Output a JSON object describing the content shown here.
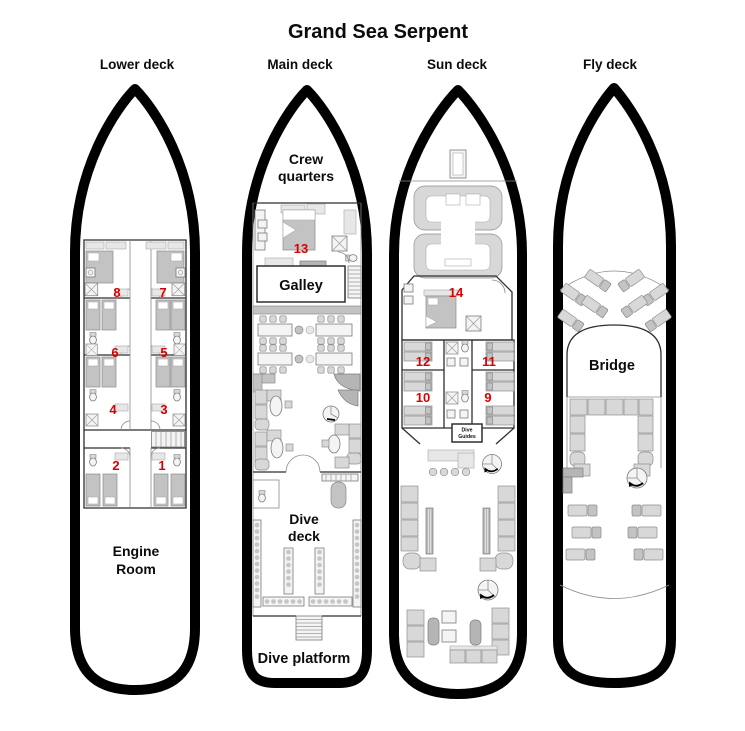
{
  "title": "Grand Sea Serpent",
  "colors": {
    "cabin_number_red": "#d90000",
    "hull_outline": "#000000",
    "furniture_gray": "#d8d8d8",
    "background": "#ffffff"
  },
  "decks": {
    "lower": {
      "label": "Lower deck",
      "cabin_numbers": [
        "1",
        "2",
        "3",
        "4",
        "5",
        "6",
        "7",
        "8"
      ],
      "rooms": {
        "engine_line1": "Engine",
        "engine_line2": "Room"
      }
    },
    "main": {
      "label": "Main deck",
      "cabin_numbers": [
        "13"
      ],
      "rooms": {
        "crew_line1": "Crew",
        "crew_line2": "quarters",
        "galley": "Galley",
        "dive_deck_line1": "Dive",
        "dive_deck_line2": "deck",
        "dive_platform": "Dive platform"
      }
    },
    "sun": {
      "label": "Sun deck",
      "cabin_numbers": [
        "9",
        "10",
        "11",
        "12",
        "14"
      ],
      "rooms": {
        "dive_guides_line1": "Dive",
        "dive_guides_line2": "Guides"
      }
    },
    "fly": {
      "label": "Fly deck",
      "rooms": {
        "bridge": "Bridge"
      }
    }
  }
}
